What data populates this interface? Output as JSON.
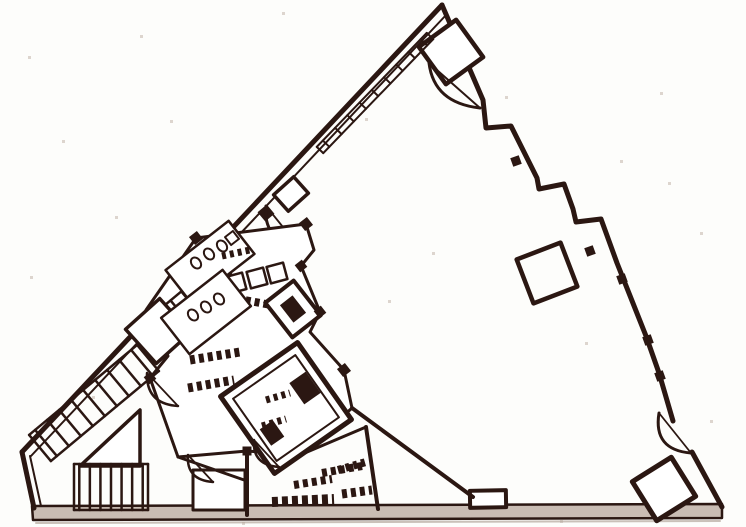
{
  "page": {
    "background": "#fdfdfb",
    "ink": "#2b1712",
    "paper_speck": "#ddd5ce",
    "floor_band": "#c9bcb3",
    "shadow": "#b3a69d"
  },
  "diagram": {
    "type": "floor-plan",
    "canvas": {
      "width": 746,
      "height": 527
    },
    "speckles": [
      [
        140,
        35
      ],
      [
        282,
        12
      ],
      [
        365,
        118
      ],
      [
        505,
        96
      ],
      [
        668,
        182
      ],
      [
        700,
        232
      ],
      [
        62,
        140
      ],
      [
        30,
        276
      ],
      [
        115,
        216
      ],
      [
        585,
        342
      ],
      [
        432,
        252
      ],
      [
        660,
        92
      ],
      [
        710,
        420
      ],
      [
        92,
        396
      ],
      [
        560,
        520
      ],
      [
        242,
        522
      ],
      [
        28,
        56
      ],
      [
        388,
        300
      ],
      [
        620,
        160
      ],
      [
        170,
        120
      ]
    ],
    "elements": [
      {
        "name": "baseline-shadow",
        "type": "line",
        "x1": 36,
        "y1": 523,
        "x2": 720,
        "y2": 521,
        "sw": 2,
        "color": "#b3a69d",
        "opacity": 0.7
      },
      {
        "name": "baseline-band",
        "type": "path",
        "d": "M 32 506 L 722 504 L 722 518 L 33 520 Z",
        "sw": 2.5,
        "fill": "#c9bcb3"
      },
      {
        "name": "left-wall-outer",
        "type": "line",
        "x1": 442,
        "y1": 5,
        "x2": 22,
        "y2": 452,
        "sw": 5
      },
      {
        "name": "left-wall-inner",
        "type": "line",
        "x1": 447,
        "y1": 14,
        "x2": 31,
        "y2": 456,
        "sw": 2
      },
      {
        "name": "left-corner-wall-outer",
        "type": "line",
        "x1": 22,
        "y1": 452,
        "x2": 34,
        "y2": 508,
        "sw": 5
      },
      {
        "name": "left-corner-wall-inner",
        "type": "line",
        "x1": 30,
        "y1": 456,
        "x2": 41,
        "y2": 506,
        "sw": 2
      },
      {
        "name": "right-wall-stepped",
        "type": "path",
        "d": "M 442 5 L 483 100 L 486 128 L 511 126 L 537 178 L 539 189 L 564 184 L 573 209 L 576 222 L 601 219 L 617 263 L 646 336 L 659 373 L 673 421",
        "sw": 5
      },
      {
        "name": "right-wall-lower",
        "type": "line",
        "x1": 692,
        "y1": 452,
        "x2": 722,
        "y2": 507,
        "sw": 5
      },
      {
        "name": "wall-tooth-1",
        "type": "rotrect",
        "cx": 516,
        "cy": 161,
        "w": 9,
        "h": 9,
        "a": -20,
        "sw": 0,
        "fill": "ink"
      },
      {
        "name": "wall-tooth-2",
        "type": "rotrect",
        "cx": 590,
        "cy": 251,
        "w": 9,
        "h": 9,
        "a": -20,
        "sw": 0,
        "fill": "ink"
      },
      {
        "name": "wall-tooth-3",
        "type": "rotrect",
        "cx": 622,
        "cy": 279,
        "w": 9,
        "h": 9,
        "a": -20,
        "sw": 0,
        "fill": "ink"
      },
      {
        "name": "wall-tooth-4",
        "type": "rotrect",
        "cx": 648,
        "cy": 340,
        "w": 9,
        "h": 9,
        "a": -20,
        "sw": 0,
        "fill": "ink"
      },
      {
        "name": "wall-tooth-5",
        "type": "rotrect",
        "cx": 660,
        "cy": 376,
        "w": 9,
        "h": 9,
        "a": -20,
        "sw": 0,
        "fill": "ink"
      },
      {
        "name": "apex-room-square",
        "type": "rotrect",
        "cx": 451,
        "cy": 52,
        "w": 46,
        "h": 46,
        "a": -36,
        "sw": 4.5,
        "fill": "#ffffff"
      },
      {
        "name": "apex-door-arc",
        "type": "path",
        "d": "M 429 63 Q 434 103 480 108",
        "sw": 3
      },
      {
        "name": "apex-door-chord",
        "type": "line",
        "x1": 429,
        "y1": 63,
        "x2": 480,
        "y2": 108,
        "sw": 2
      },
      {
        "name": "column-square",
        "type": "rotrect",
        "cx": 547,
        "cy": 273,
        "w": 47,
        "h": 47,
        "a": -21,
        "sw": 4.5
      },
      {
        "name": "corner-room-square",
        "type": "rotrect",
        "cx": 664,
        "cy": 489,
        "w": 46,
        "h": 46,
        "a": -32,
        "sw": 5,
        "fill": "#ffffff"
      },
      {
        "name": "entry-door-arc",
        "type": "path",
        "d": "M 659 413 Q 653 450 691 453",
        "sw": 3
      },
      {
        "name": "entry-door-chord",
        "type": "line",
        "x1": 659,
        "y1": 413,
        "x2": 691,
        "y2": 453,
        "sw": 1.8
      },
      {
        "name": "bottom-bump",
        "type": "rotrect",
        "cx": 488,
        "cy": 499,
        "w": 36,
        "h": 17,
        "a": -1,
        "sw": 4,
        "fill": "#ffffff"
      },
      {
        "name": "facade-mullions",
        "type": "stairs",
        "x1": 320,
        "y1": 150,
        "x2": 430,
        "y2": 36,
        "width": 9,
        "count": 9,
        "sw": 2
      },
      {
        "name": "edge-landing-rect",
        "type": "rotrect",
        "cx": 291,
        "cy": 194,
        "w": 27,
        "h": 22,
        "a": -42,
        "sw": 3.5,
        "fill": "#ffffff"
      },
      {
        "name": "edge-door-jamb",
        "type": "rotrect",
        "cx": 266,
        "cy": 213,
        "w": 12,
        "h": 12,
        "a": -40,
        "sw": 0,
        "fill": "ink"
      },
      {
        "name": "edge-door-arc",
        "type": "path",
        "d": "M 266 206 Q 263 240 295 242",
        "sw": 3
      },
      {
        "name": "edge-door-chord",
        "type": "line",
        "x1": 266,
        "y1": 206,
        "x2": 295,
        "y2": 242,
        "sw": 1.8
      },
      {
        "name": "core-outline",
        "type": "path",
        "d": "M 196 238 L 306 224 L 314 250 L 301 266 L 320 312 L 310 332 L 344 370 L 352 408 L 300 455 L 247 451 L 178 457 L 150 378 L 168 356 L 146 310 Z",
        "sw": 3,
        "fill": "#ffffff"
      },
      {
        "name": "stairwell-band-upper",
        "type": "stairs",
        "x1": 176,
        "y1": 318,
        "x2": 230,
        "y2": 273,
        "width": 34,
        "count": 5,
        "sw": 2.5
      },
      {
        "name": "stairwell-landing",
        "type": "rotrect",
        "cx": 158,
        "cy": 331,
        "w": 46,
        "h": 46,
        "a": -42,
        "sw": 3.5,
        "fill": "#ffffff"
      },
      {
        "name": "stairwell-band-lower",
        "type": "stairs",
        "x1": 40,
        "y1": 448,
        "x2": 148,
        "y2": 358,
        "width": 34,
        "count": 9,
        "sw": 2.5
      },
      {
        "name": "ramp-triangle",
        "type": "path",
        "d": "M 80 466 L 140 410 L 140 466 Z",
        "sw": 3.5,
        "fill": "#ffffff"
      },
      {
        "name": "lower-stair-bars",
        "type": "stairs",
        "x1": 74,
        "y1": 487,
        "x2": 148,
        "y2": 487,
        "width": 46,
        "count": 7,
        "sw": 2.5
      },
      {
        "name": "basement-room",
        "type": "rotrect",
        "cx": 219,
        "cy": 490,
        "w": 52,
        "h": 40,
        "a": 0,
        "sw": 3,
        "fill": "#ffffff"
      },
      {
        "name": "core-wall-vertical",
        "type": "line",
        "x1": 247,
        "y1": 451,
        "x2": 247,
        "y2": 515,
        "sw": 4
      },
      {
        "name": "core-wall-lower",
        "type": "line",
        "x1": 178,
        "y1": 457,
        "x2": 247,
        "y2": 481,
        "sw": 3
      },
      {
        "name": "partition-diagonal",
        "type": "line",
        "x1": 352,
        "y1": 408,
        "x2": 473,
        "y2": 497,
        "sw": 4
      },
      {
        "name": "service-wall",
        "type": "line",
        "x1": 366,
        "y1": 427,
        "x2": 378,
        "y2": 509,
        "sw": 4
      },
      {
        "name": "service-wall-top",
        "type": "line",
        "x1": 300,
        "y1": 455,
        "x2": 366,
        "y2": 427,
        "sw": 3
      },
      {
        "name": "machine-room",
        "type": "rotrect",
        "cx": 286,
        "cy": 408,
        "w": 94,
        "h": 94,
        "a": -35,
        "sw": 5,
        "fill": "#ffffff"
      },
      {
        "name": "machine-room-inner",
        "type": "rotrect",
        "cx": 286,
        "cy": 408,
        "w": 76,
        "h": 76,
        "a": -35,
        "sw": 2
      },
      {
        "name": "machine-room-equip-1",
        "type": "rotrect",
        "cx": 305,
        "cy": 388,
        "w": 20,
        "h": 26,
        "a": -35,
        "sw": 0,
        "fill": "ink"
      },
      {
        "name": "machine-room-equip-2",
        "type": "rotrect",
        "cx": 272,
        "cy": 433,
        "w": 16,
        "h": 20,
        "a": -35,
        "sw": 0,
        "fill": "ink"
      },
      {
        "name": "machine-room-label-1",
        "type": "line",
        "x1": 266,
        "y1": 400,
        "x2": 290,
        "y2": 393,
        "sw": 7,
        "dash": "4 4"
      },
      {
        "name": "machine-room-label-2",
        "type": "line",
        "x1": 262,
        "y1": 426,
        "x2": 286,
        "y2": 419,
        "sw": 7,
        "dash": "4 4"
      },
      {
        "name": "elevator-cab-1",
        "type": "rotrect",
        "cx": 236,
        "cy": 283,
        "w": 17,
        "h": 17,
        "a": -15,
        "sw": 2.5,
        "fill": "#ffffff"
      },
      {
        "name": "elevator-cab-2",
        "type": "rotrect",
        "cx": 257,
        "cy": 278,
        "w": 17,
        "h": 17,
        "a": -15,
        "sw": 2.5,
        "fill": "#ffffff"
      },
      {
        "name": "elevator-cab-3",
        "type": "rotrect",
        "cx": 277,
        "cy": 273,
        "w": 17,
        "h": 17,
        "a": -15,
        "sw": 2.5,
        "fill": "#ffffff"
      },
      {
        "name": "elevator-label-row",
        "type": "line",
        "x1": 228,
        "y1": 297,
        "x2": 271,
        "y2": 305,
        "sw": 8,
        "dash": "5 4"
      },
      {
        "name": "duct-room",
        "type": "rotrect",
        "cx": 293,
        "cy": 309,
        "w": 36,
        "h": 44,
        "a": -38,
        "sw": 4,
        "fill": "#ffffff"
      },
      {
        "name": "duct-room-fill",
        "type": "rotrect",
        "cx": 293,
        "cy": 309,
        "w": 16,
        "h": 22,
        "a": -38,
        "sw": 0,
        "fill": "ink"
      },
      {
        "name": "restroom-upper",
        "type": "rotrect",
        "cx": 210,
        "cy": 262,
        "w": 80,
        "h": 42,
        "a": -38,
        "sw": 2.5,
        "fill": "#ffffff"
      },
      {
        "name": "toilet-fixture-1",
        "type": "ellipse",
        "cx": 196,
        "cy": 263,
        "rx": 4.5,
        "ry": 6,
        "a": -38,
        "sw": 2
      },
      {
        "name": "toilet-fixture-2",
        "type": "ellipse",
        "cx": 209,
        "cy": 254,
        "rx": 4.5,
        "ry": 6,
        "a": -38,
        "sw": 2
      },
      {
        "name": "toilet-fixture-3",
        "type": "ellipse",
        "cx": 222,
        "cy": 246,
        "rx": 4.5,
        "ry": 6,
        "a": -38,
        "sw": 2
      },
      {
        "name": "restroom-sink",
        "type": "rotrect",
        "cx": 232,
        "cy": 238,
        "w": 10,
        "h": 10,
        "a": -38,
        "sw": 2
      },
      {
        "name": "restroom-lower",
        "type": "rotrect",
        "cx": 206,
        "cy": 312,
        "w": 78,
        "h": 46,
        "a": -38,
        "sw": 2.5,
        "fill": "#ffffff"
      },
      {
        "name": "toilet-fixture-4",
        "type": "ellipse",
        "cx": 193,
        "cy": 315,
        "rx": 4.5,
        "ry": 6,
        "a": -38,
        "sw": 2
      },
      {
        "name": "toilet-fixture-5",
        "type": "ellipse",
        "cx": 206,
        "cy": 307,
        "rx": 4.5,
        "ry": 6,
        "a": -38,
        "sw": 2
      },
      {
        "name": "toilet-fixture-6",
        "type": "ellipse",
        "cx": 219,
        "cy": 299,
        "rx": 4.5,
        "ry": 6,
        "a": -38,
        "sw": 2
      },
      {
        "name": "door-fan-1-arc",
        "type": "path",
        "d": "M 147 373 Q 146 404 178 406",
        "sw": 2.5
      },
      {
        "name": "door-fan-1-chord",
        "type": "line",
        "x1": 147,
        "y1": 373,
        "x2": 178,
        "y2": 406,
        "sw": 1.8
      },
      {
        "name": "door-fan-2-arc",
        "type": "path",
        "d": "M 188 455 Q 186 480 213 482",
        "sw": 2.5
      },
      {
        "name": "door-fan-2-chord",
        "type": "line",
        "x1": 188,
        "y1": 455,
        "x2": 213,
        "y2": 482,
        "sw": 1.8
      },
      {
        "name": "door-fan-3-arc",
        "type": "path",
        "d": "M 254 440 Q 252 465 279 467",
        "sw": 2.5
      },
      {
        "name": "door-fan-3-chord",
        "type": "line",
        "x1": 254,
        "y1": 440,
        "x2": 279,
        "y2": 467,
        "sw": 1.8
      },
      {
        "name": "label-row-1",
        "type": "line",
        "x1": 190,
        "y1": 360,
        "x2": 240,
        "y2": 352,
        "sw": 9,
        "dash": "5 4"
      },
      {
        "name": "label-row-2",
        "type": "line",
        "x1": 188,
        "y1": 388,
        "x2": 234,
        "y2": 380,
        "sw": 9,
        "dash": "5 4"
      },
      {
        "name": "label-row-3",
        "type": "line",
        "x1": 222,
        "y1": 256,
        "x2": 250,
        "y2": 250,
        "sw": 7,
        "dash": "4 4"
      },
      {
        "name": "label-row-4",
        "type": "line",
        "x1": 272,
        "y1": 502,
        "x2": 334,
        "y2": 499,
        "sw": 10,
        "dash": "6 4"
      },
      {
        "name": "label-row-5",
        "type": "line",
        "x1": 294,
        "y1": 485,
        "x2": 332,
        "y2": 479,
        "sw": 8,
        "dash": "5 4"
      },
      {
        "name": "label-row-6",
        "type": "line",
        "x1": 322,
        "y1": 473,
        "x2": 362,
        "y2": 466,
        "sw": 8,
        "dash": "5 4"
      },
      {
        "name": "service-label-1",
        "type": "line",
        "x1": 338,
        "y1": 470,
        "x2": 366,
        "y2": 462,
        "sw": 8,
        "dash": "4 4"
      },
      {
        "name": "service-label-2",
        "type": "line",
        "x1": 342,
        "y1": 494,
        "x2": 372,
        "y2": 490,
        "sw": 9,
        "dash": "5 4"
      },
      {
        "name": "wall-junction-1",
        "type": "rotrect",
        "cx": 196,
        "cy": 238,
        "w": 10,
        "h": 10,
        "a": -38,
        "sw": 0,
        "fill": "ink"
      },
      {
        "name": "wall-junction-2",
        "type": "rotrect",
        "cx": 306,
        "cy": 224,
        "w": 10,
        "h": 10,
        "a": -38,
        "sw": 0,
        "fill": "ink"
      },
      {
        "name": "wall-junction-3",
        "type": "rotrect",
        "cx": 150,
        "cy": 378,
        "w": 9,
        "h": 9,
        "a": -38,
        "sw": 0,
        "fill": "ink"
      },
      {
        "name": "wall-junction-4",
        "type": "rotrect",
        "cx": 344,
        "cy": 370,
        "w": 10,
        "h": 10,
        "a": -38,
        "sw": 0,
        "fill": "ink"
      },
      {
        "name": "wall-junction-5",
        "type": "rotrect",
        "cx": 301,
        "cy": 266,
        "w": 9,
        "h": 9,
        "a": -38,
        "sw": 0,
        "fill": "ink"
      },
      {
        "name": "wall-junction-6",
        "type": "rotrect",
        "cx": 320,
        "cy": 312,
        "w": 9,
        "h": 9,
        "a": -38,
        "sw": 0,
        "fill": "ink"
      },
      {
        "name": "wall-junction-7",
        "type": "rotrect",
        "cx": 247,
        "cy": 451,
        "w": 9,
        "h": 9,
        "a": 0,
        "sw": 0,
        "fill": "ink"
      }
    ]
  }
}
